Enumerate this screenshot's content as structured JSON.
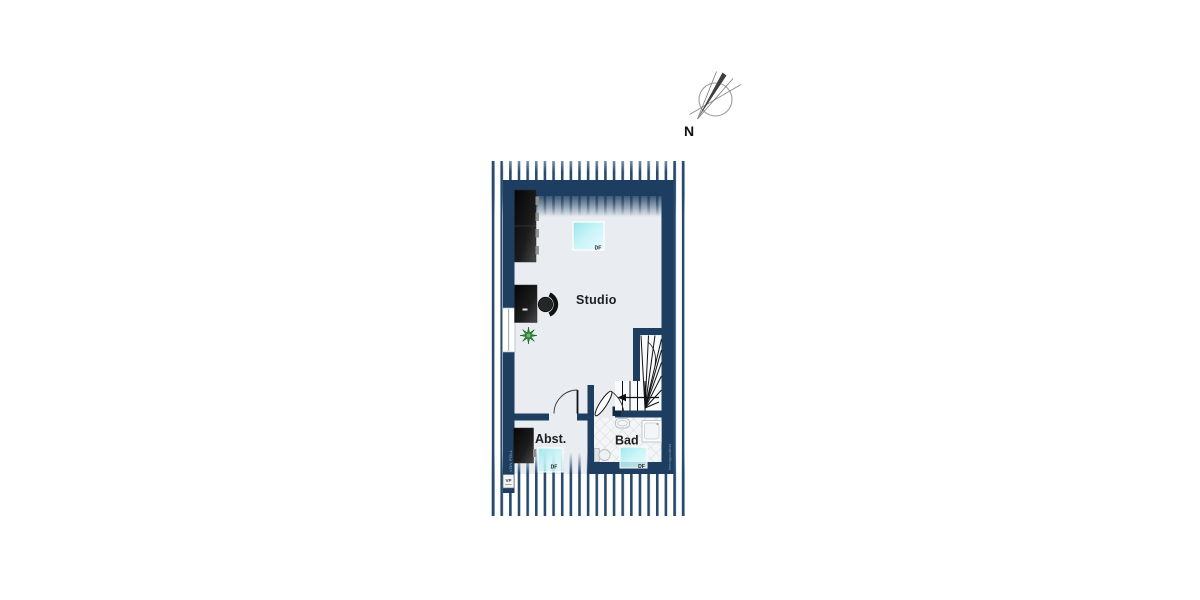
{
  "compass": {
    "north_label": "N"
  },
  "rooms": {
    "studio_label": "Studio",
    "abst_label": "Abst.",
    "bad_label": "Bad"
  },
  "skylights": {
    "studio_df": "DF",
    "abst_df": "DF",
    "bad_df": "DF"
  },
  "watermarks": {
    "left_logo": "VP",
    "left_text": "VON POLL",
    "right_text": "Immogrundriss"
  },
  "colors": {
    "wall": "#1d3e60",
    "stripes": "#274a6d",
    "floor": "#e9edf2",
    "skylight": "#aee9ef",
    "tile_line": "#ced4da",
    "plant_green": "#2e7d32",
    "label_text": "#1e1e1e"
  }
}
